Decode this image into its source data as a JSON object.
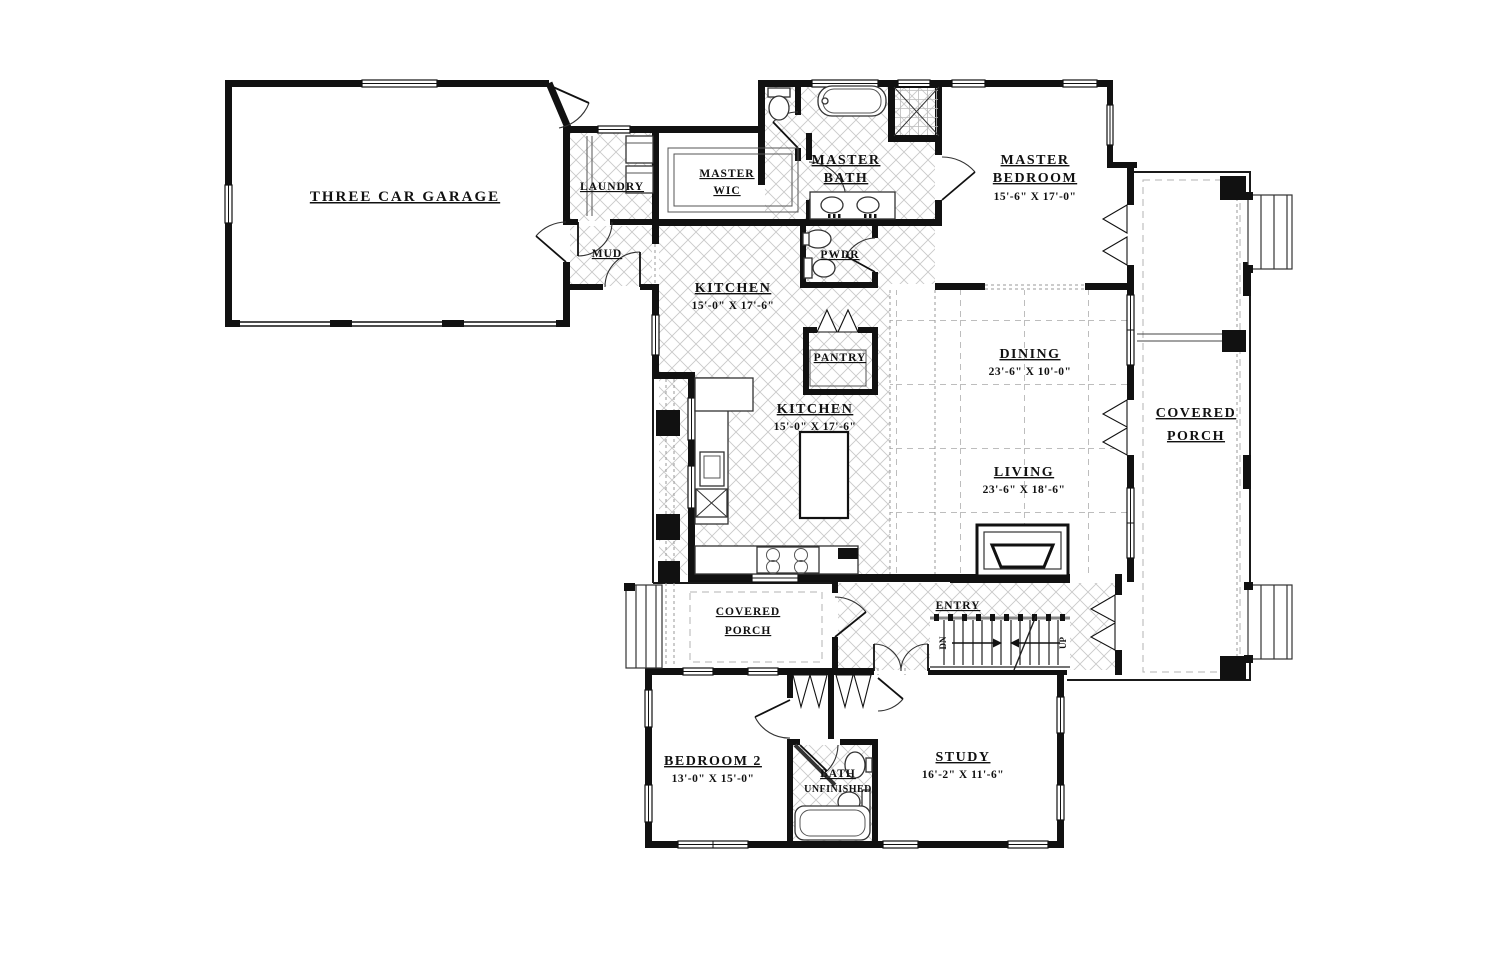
{
  "colors": {
    "wall": "#111111",
    "tile_line": "#c9c9c9",
    "dash_line": "#b3b3b3",
    "background": "#ffffff"
  },
  "labels": {
    "garage": {
      "name": "THREE CAR GARAGE"
    },
    "laundry": {
      "name": "LAUNDRY"
    },
    "mud": {
      "name": "MUD"
    },
    "master_wic": {
      "line1": "MASTER",
      "line2": "WIC"
    },
    "master_bath": {
      "line1": "MASTER",
      "line2": "BATH"
    },
    "pwdr": {
      "name": "PWDR"
    },
    "master_bedroom": {
      "line1": "MASTER",
      "line2": "BEDROOM",
      "dims": "15'-6\" X 17'-0\""
    },
    "kitchen_upper": {
      "name": "KITCHEN",
      "dims": "15'-0\" X 17'-6\""
    },
    "kitchen": {
      "name": "KITCHEN",
      "dims": "15'-0\" X 17'-6\""
    },
    "pantry": {
      "name": "PANTRY"
    },
    "dining": {
      "name": "DINING",
      "dims": "23'-6\" X 10'-0\""
    },
    "living": {
      "name": "LIVING",
      "dims": "23'-6\" X 18'-6\""
    },
    "covered_porch_right": {
      "line1": "COVERED",
      "line2": "PORCH"
    },
    "covered_porch_left": {
      "line1": "COVERED",
      "line2": "PORCH"
    },
    "entry": {
      "name": "ENTRY"
    },
    "bedroom2": {
      "name": "BEDROOM 2",
      "dims": "13'-0\" X 15'-0\""
    },
    "bath2": {
      "name": "BATH",
      "sub": "UNFINISHED"
    },
    "study": {
      "name": "STUDY",
      "dims": "16'-2\" X 11'-6\""
    },
    "stairs": {
      "down": "DN",
      "up": "UP"
    }
  }
}
